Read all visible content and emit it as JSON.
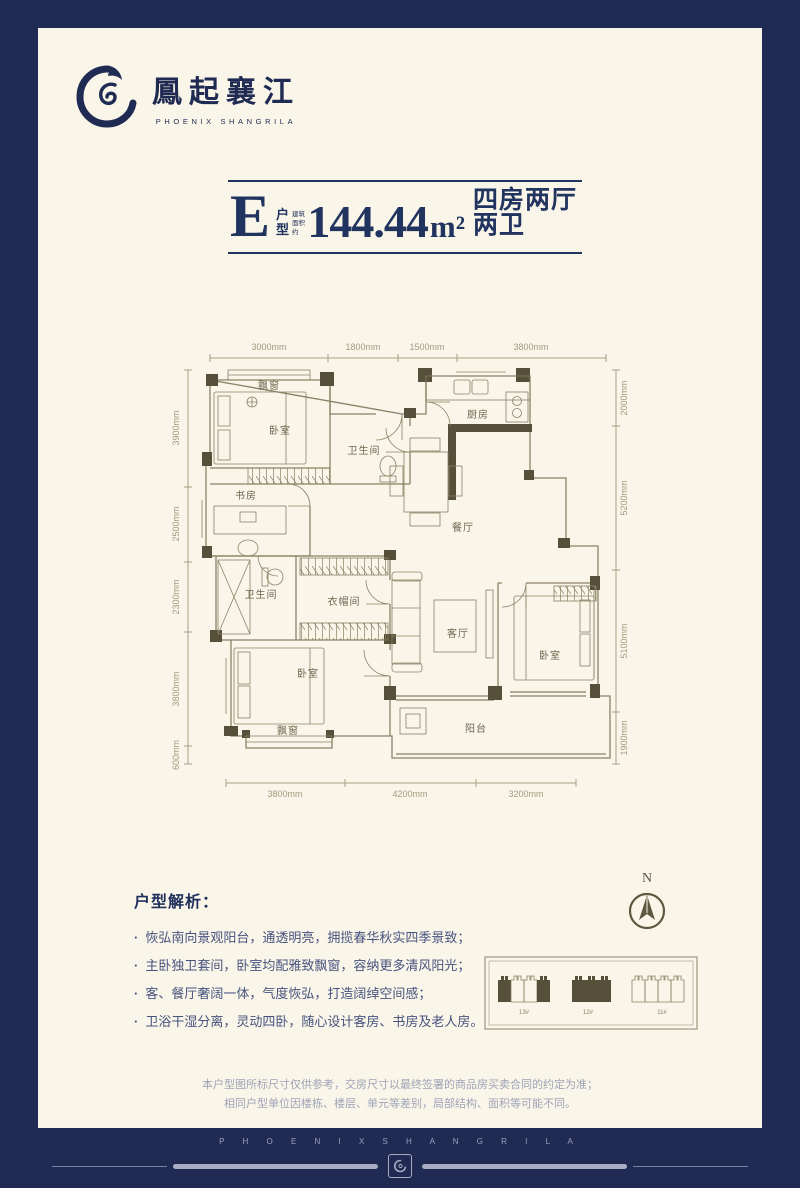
{
  "brand": {
    "name_cn": "鳳起襄江",
    "name_en": "PHOENIX SHANGRILA"
  },
  "title": {
    "type_letter": "E",
    "type_word_top": "户",
    "type_word_bottom": "型",
    "area_prefix_top": "建筑",
    "area_prefix_bottom": "面积约",
    "area_value": "144.44",
    "area_unit": "m²",
    "layout_desc": "四房两厅两卫"
  },
  "floorplan": {
    "dims_top": [
      "3000mm",
      "1800mm",
      "1500mm",
      "3800mm"
    ],
    "dims_left": [
      "3900mm",
      "2500mm",
      "2300mm",
      "3800mm",
      "600mm"
    ],
    "dims_right": [
      "2000mm",
      "5200mm",
      "5100mm",
      "1900mm"
    ],
    "dims_bottom": [
      "3800mm",
      "4200mm",
      "3200mm"
    ],
    "rooms": {
      "bay_window_top": "飘窗",
      "bedroom_top": "卧室",
      "bathroom_top": "卫生间",
      "kitchen": "厨房",
      "study": "书房",
      "dining": "餐厅",
      "bathroom_mid": "卫生间",
      "cloakroom": "衣帽间",
      "bedroom_master": "卧室",
      "living": "客厅",
      "bedroom_east": "卧室",
      "bay_window_bottom": "飘窗",
      "balcony": "阳台"
    }
  },
  "analysis": {
    "heading": "户型解析：",
    "bullets": [
      "恢弘南向景观阳台，通透明亮，拥揽春华秋实四季景致；",
      "主卧独卫套间，卧室均配雅致飘窗，容纳更多清风阳光；",
      "客、餐厅奢阔一体，气度恢弘，打造阔绰空间感；",
      "卫浴干湿分离，灵动四卧，随心设计客房、书房及老人房。"
    ]
  },
  "compass": {
    "label": "N"
  },
  "keyplan": {
    "buildings": [
      "13#",
      "12#",
      "11#"
    ]
  },
  "disclaimer": {
    "line1": "本户型图所标尺寸仅供参考，交房尺寸以最终签署的商品房买卖合同的约定为准；",
    "line2": "相同户型单位因楼栋、楼层、单元等差别，局部结构、面积等可能不同。"
  },
  "footer": {
    "brand_en": "P H O E N I X   S H A N G R I L A"
  },
  "colors": {
    "navy": "#202b54",
    "cream": "#f9f5e8",
    "wall": "#564f39",
    "line": "#8a8166"
  }
}
